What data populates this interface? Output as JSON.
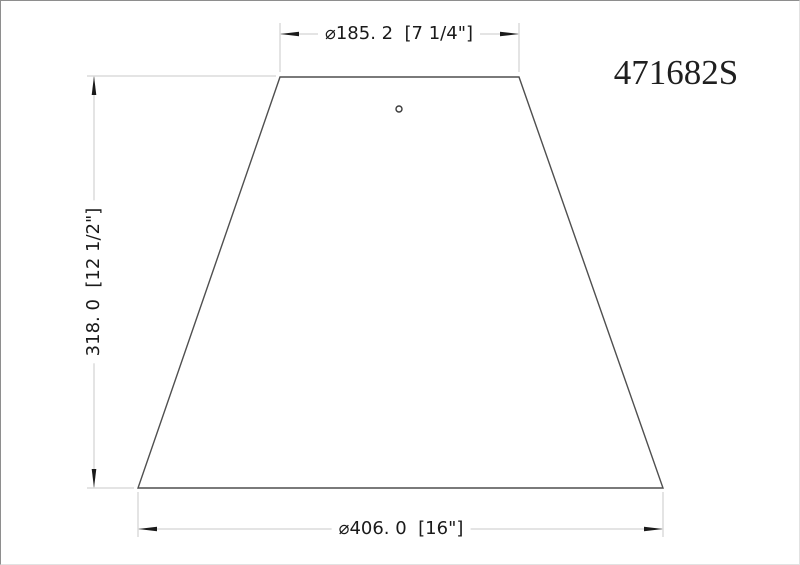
{
  "part_number": "471682S",
  "dimensions": {
    "top_label": "⌀185. 2  [7 1/4\"]",
    "left_label": "318. 0  [12 1/2\"]",
    "bottom_label": "⌀406. 0  [16\"]"
  },
  "shape": {
    "description": "trapezoid lampshade outline with small top hole",
    "top_width_mm": 185.2,
    "top_width_in": "7 1/4",
    "height_mm": 318.0,
    "height_in": "12 1/2",
    "bottom_width_mm": 406.0,
    "bottom_width_in": "16"
  },
  "colors": {
    "object_line": "#4f4f4f",
    "dimension_line": "#c9c9c9",
    "arrowhead": "#1a1a1a",
    "text": "#1a1a1a",
    "background": "#ffffff"
  }
}
